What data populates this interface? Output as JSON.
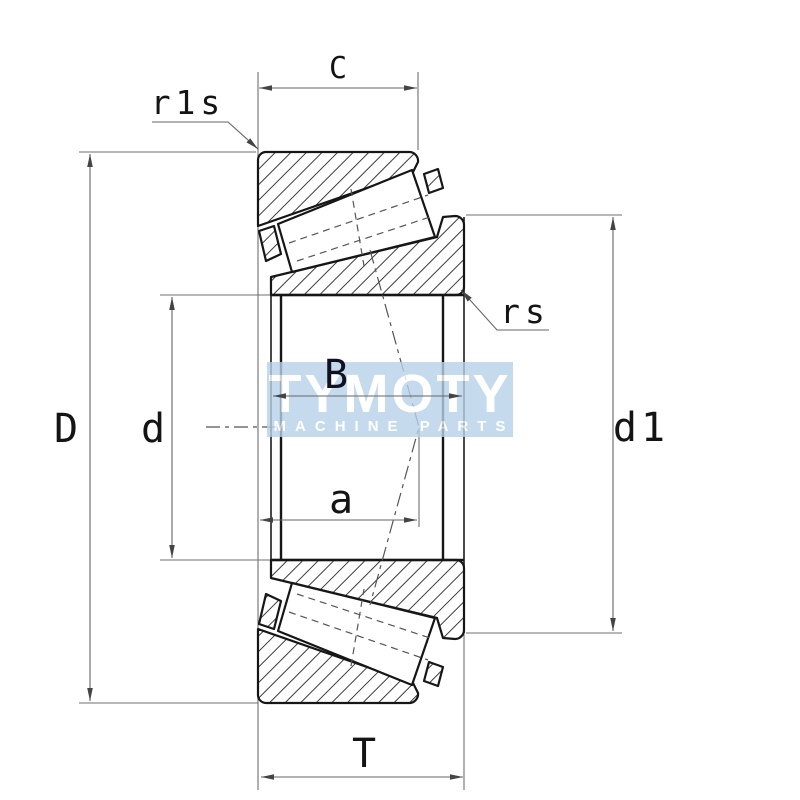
{
  "drawing": {
    "type": "tapered-roller-bearing-cross-section",
    "labels": {
      "C": "C",
      "r1s": "r1s",
      "rs": "rs",
      "D": "D",
      "d": "d",
      "B": "B",
      "a": "a",
      "d1": "d1",
      "T": "T"
    },
    "watermark": {
      "brand": "TYMOTY",
      "tagline": "MACHINE PARTS",
      "band_color": "#b7d2e9",
      "text_color": "#ffffff"
    },
    "colors": {
      "background": "#ffffff",
      "outline": "#161616",
      "hatch": "#3c3c3c",
      "dimension_line": "#666666",
      "label_text": "#141414",
      "b_label_text": "#10131f"
    }
  }
}
